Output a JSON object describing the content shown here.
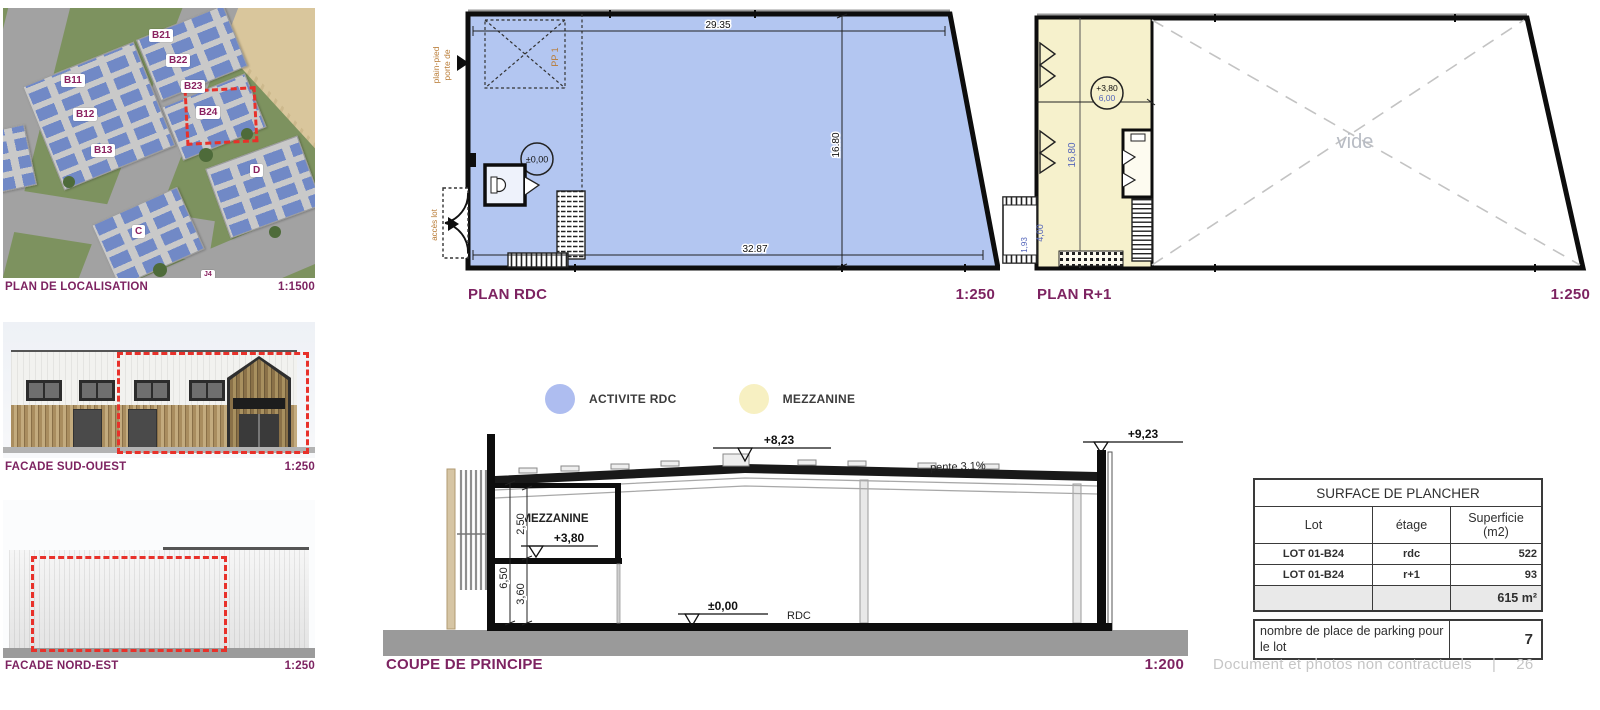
{
  "colors": {
    "accent_purple": "#7d2361",
    "lot_red": "#e8312a",
    "rdc_blue": "#b3c6f1",
    "mezzanine_cream": "#f6f1cc",
    "legend_blue": "#aebdf0",
    "legend_yellow": "#f7f0c2"
  },
  "localisation": {
    "title": "PLAN DE LOCALISATION",
    "scale": "1:1500",
    "labels": [
      "B21",
      "B22",
      "B11",
      "B23",
      "B12",
      "B24",
      "B13",
      "D",
      "C",
      "J4"
    ]
  },
  "facade_sud_ouest": {
    "title": "FACADE SUD-OUEST",
    "scale": "1:250"
  },
  "facade_nord_est": {
    "title": "FACADE NORD-EST",
    "scale": "1:250"
  },
  "plan_rdc": {
    "title": "PLAN RDC",
    "scale": "1:250",
    "dim_top": "29.35",
    "dim_height": "16.80",
    "dim_bottom": "32.87",
    "level": "±0,00",
    "pp_label": "PP 1",
    "door_label_line1": "porte de",
    "door_label_line2": "plain-pied",
    "access_label": "accès lot"
  },
  "plan_r1": {
    "title": "PLAN R+1",
    "scale": "1:250",
    "level": "+3,80",
    "dim_width": "6,00",
    "dim_height": "16,80",
    "dim_entry_depth": "4,00",
    "dim_entry_width": "1,93",
    "void_label": "vide"
  },
  "legend": {
    "activite": "ACTIVITE RDC",
    "mezzanine": "MEZZANINE"
  },
  "coupe": {
    "title": "COUPE DE PRINCIPE",
    "scale": "1:200",
    "level_roof": "+8,23",
    "level_parapet": "+9,23",
    "level_mezzanine": "+3,80",
    "level_ground": "±0,00",
    "slope": "pente 3,1%",
    "mezzanine_label": "MEZZANINE",
    "ground_label": "RDC",
    "dim_total": "6,50",
    "dim_mezzanine": "2,50",
    "dim_under": "3,60"
  },
  "table": {
    "title": "SURFACE DE PLANCHER",
    "col_lot": "Lot",
    "col_etage": "étage",
    "col_superficie": "Superficie (m2)",
    "rows": [
      {
        "lot": "LOT 01-B24",
        "etage": "rdc",
        "superficie": "522"
      },
      {
        "lot": "LOT 01-B24",
        "etage": "r+1",
        "superficie": "93"
      }
    ],
    "total": "615 m²",
    "parking_label": "nombre de place de parking pour le lot",
    "parking_value": "7"
  },
  "footer": {
    "text": "Document et photos non contractuels",
    "separator": "|",
    "page": "26"
  }
}
